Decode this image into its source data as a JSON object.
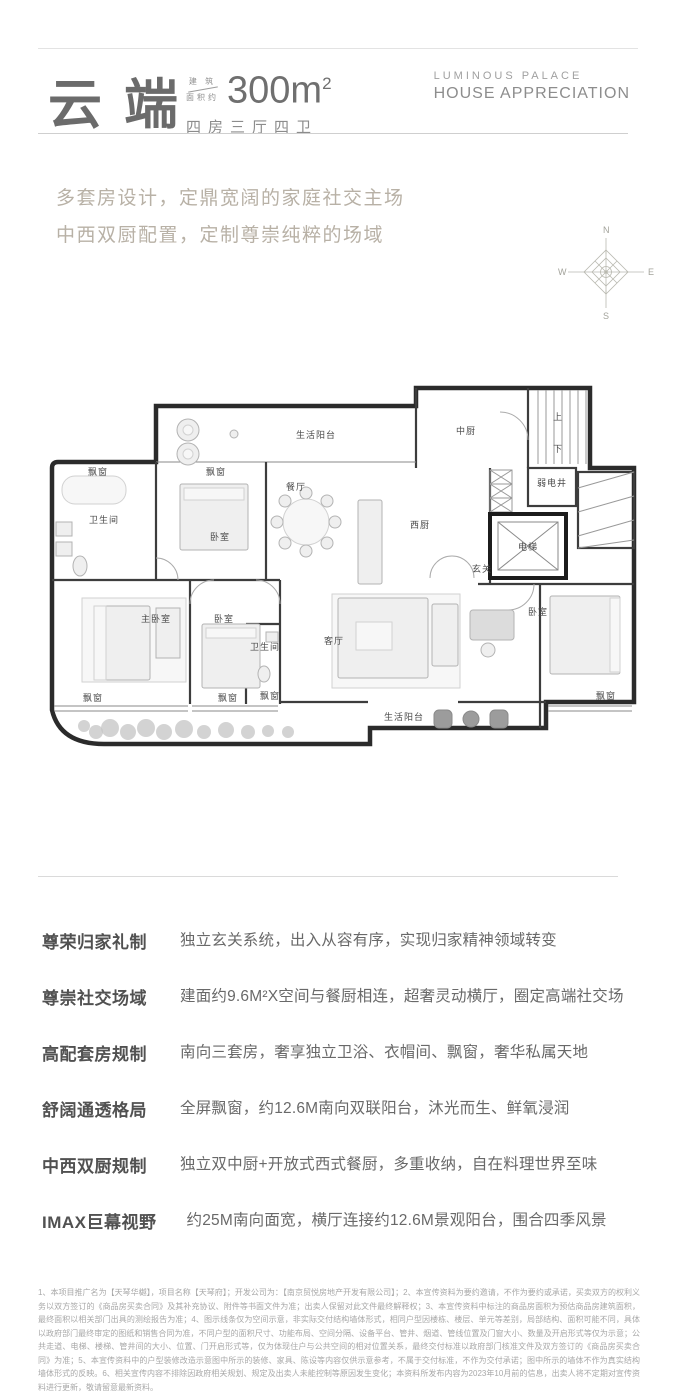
{
  "header": {
    "title": "云端",
    "area_prefix_top": "建 筑",
    "area_prefix_bottom": "面积约",
    "area_value": "300m",
    "area_sup": "2",
    "layout": "四房三厅四卫",
    "brand_line1": "LUMINOUS PALACE",
    "brand_line2": "HOUSE APPRECIATION"
  },
  "tagline": {
    "line1": "多套房设计，定鼎宽阔的家庭社交主场",
    "line2": "中西双厨配置，定制尊崇纯粹的场域"
  },
  "compass": {
    "n": "N",
    "e": "E",
    "s": "S",
    "w": "W"
  },
  "floor_plan": {
    "rooms": [
      {
        "label": "生活阳台",
        "x": 278,
        "y": 66
      },
      {
        "label": "中厨",
        "x": 428,
        "y": 62
      },
      {
        "label": "上",
        "x": 520,
        "y": 48
      },
      {
        "label": "下",
        "x": 520,
        "y": 80
      },
      {
        "label": "飘窗",
        "x": 60,
        "y": 103
      },
      {
        "label": "卫生间",
        "x": 66,
        "y": 151
      },
      {
        "label": "飘窗",
        "x": 178,
        "y": 103
      },
      {
        "label": "卧室",
        "x": 182,
        "y": 168
      },
      {
        "label": "餐厅",
        "x": 258,
        "y": 118
      },
      {
        "label": "西厨",
        "x": 382,
        "y": 156
      },
      {
        "label": "弱电井",
        "x": 514,
        "y": 114
      },
      {
        "label": "电梯",
        "x": 490,
        "y": 178
      },
      {
        "label": "玄关",
        "x": 444,
        "y": 200
      },
      {
        "label": "主卧室",
        "x": 118,
        "y": 250
      },
      {
        "label": "卧室",
        "x": 186,
        "y": 250
      },
      {
        "label": "卫生间",
        "x": 227,
        "y": 278
      },
      {
        "label": "客厅",
        "x": 296,
        "y": 272
      },
      {
        "label": "卧室",
        "x": 500,
        "y": 243
      },
      {
        "label": "生活阳台",
        "x": 366,
        "y": 348
      },
      {
        "label": "飘窗",
        "x": 55,
        "y": 329
      },
      {
        "label": "飘窗",
        "x": 190,
        "y": 329
      },
      {
        "label": "飘窗",
        "x": 232,
        "y": 327
      },
      {
        "label": "飘窗",
        "x": 568,
        "y": 327
      }
    ]
  },
  "features": [
    {
      "label": "尊荣归家礼制",
      "description": "独立玄关系统，出入从容有序，实现归家精神领域转变"
    },
    {
      "label": "尊崇社交场域",
      "description": "建面约9.6M²X空间与餐厨相连，超奢灵动横厅，圈定高端社交场"
    },
    {
      "label": "高配套房规制",
      "description": "南向三套房，奢享独立卫浴、衣帽间、飘窗，奢华私属天地"
    },
    {
      "label": "舒阔通透格局",
      "description": "全屏飘窗，约12.6M南向双联阳台，沐光而生、鲜氧浸润"
    },
    {
      "label": "中西双厨规制",
      "description": "独立双中厨+开放式西式餐厨，多重收纳，自在料理世界至味"
    },
    {
      "label": "IMAX巨幕视野",
      "description": "约25M南向面宽，横厅连接约12.6M景观阳台，围合四季风景"
    }
  ],
  "disclaimer": "1、本项目推广名为【天琴华樾】，项目名称【天琴府】；开发公司为：【南京贸悦房地产开发有限公司】；2、本宣传资料为要约邀请，不作为要约或承诺，买卖双方的权利义务以双方签订的《商品房买卖合同》及其补充协议、附件等书面文件为准；出卖人保留对此文件最终解释权；3、本宣传资料中标注的商品房面积为预估商品房建筑面积，最终面积以相关部门出具的测绘报告为准；4、图示线条仅为空间示意，非实际交付结构墙体形式，相同户型因楼栋、楼层、单元等差别，局部结构、面积可能不同，具体以政府部门最终审定的图纸和销售合同为准，不同户型的面积尺寸、功能布局、空间分隔、设备平台、管井、烟道、管线位置及门窗大小、数量及开启形式等仅为示意；公共走道、电梯、楼梯、管井间的大小、位置、门开启形式等，仅为体现住户与公共空间的相对位置关系，最终交付标准以政府部门核准文件及双方签订的《商品房买卖合同》为准；5、本宣传资料中的户型装修改造示意图中所示的装修、家具、陈设等内容仅供示意参考，不属于交付标准，不作为交付承诺；图中所示的墙体不作为真实结构墙体形式的反映。6、相关宣传内容不排除因政府相关规划、规定及出卖人未能控制等原因发生变化；本资料所发布内容为2023年10月前的信息，出卖人将不定期对宣传资料进行更新，敬请留意最新资料。",
  "colors": {
    "title": "#6b6b6b",
    "tagline": "#b8b1a6",
    "divider": "#d9d9d9",
    "feature_label": "#515151",
    "feature_text": "#696969",
    "fineprint": "#a8a8a8",
    "wall": "#2b2b2b"
  }
}
